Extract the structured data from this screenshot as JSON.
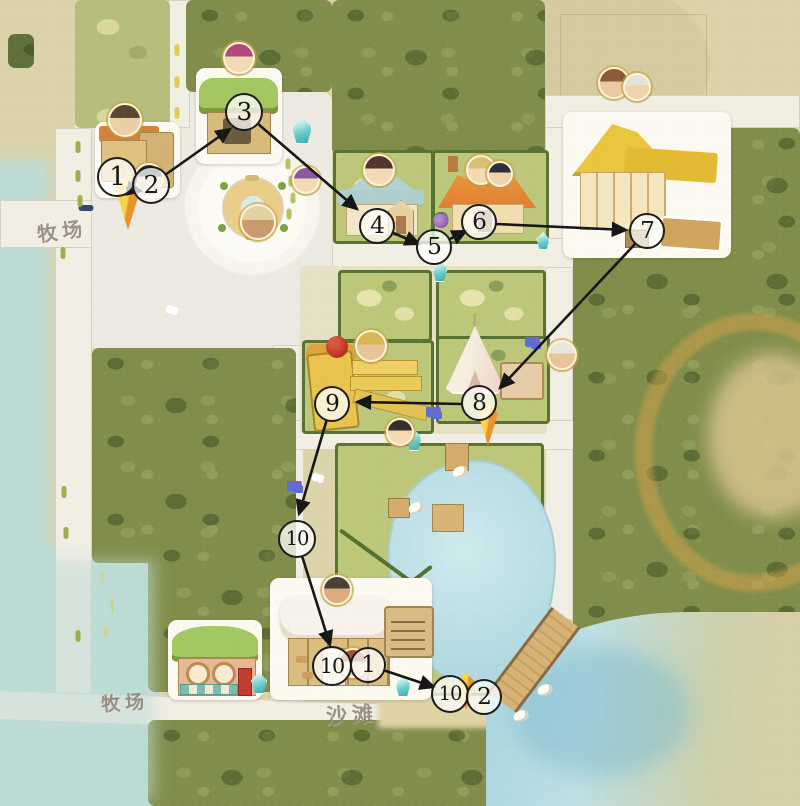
{
  "labels": [
    {
      "id": "ranch-west",
      "text": "牧场",
      "x": 62,
      "y": 230,
      "size": 20,
      "rot": -8
    },
    {
      "id": "ranch-south",
      "text": "牧场",
      "x": 125,
      "y": 702,
      "size": 19,
      "rot": -4
    },
    {
      "id": "beach",
      "text": "沙滩",
      "x": 352,
      "y": 714,
      "size": 21,
      "rot": -4
    }
  ],
  "waypoints": [
    {
      "id": "1",
      "label": "1",
      "x": 117,
      "y": 177,
      "r": 18
    },
    {
      "id": "2",
      "label": "2",
      "x": 151,
      "y": 185,
      "r": 17
    },
    {
      "id": "3",
      "label": "3",
      "x": 244,
      "y": 112,
      "r": 17
    },
    {
      "id": "4",
      "label": "4",
      "x": 377,
      "y": 226,
      "r": 16
    },
    {
      "id": "5",
      "label": "5",
      "x": 434,
      "y": 247,
      "r": 16
    },
    {
      "id": "6",
      "label": "6",
      "x": 479,
      "y": 222,
      "r": 16
    },
    {
      "id": "7",
      "label": "7",
      "x": 647,
      "y": 231,
      "r": 16
    },
    {
      "id": "8",
      "label": "8",
      "x": 479,
      "y": 403,
      "r": 16
    },
    {
      "id": "9",
      "label": "9",
      "x": 332,
      "y": 404,
      "r": 16
    },
    {
      "id": "10",
      "label": "10",
      "x": 297,
      "y": 539,
      "r": 17
    },
    {
      "id": "10-restaurant",
      "label": "10",
      "x": 332,
      "y": 666,
      "r": 18
    },
    {
      "id": "1-restaurant",
      "label": "1",
      "x": 368,
      "y": 665,
      "r": 16
    },
    {
      "id": "10-beach",
      "label": "10",
      "x": 450,
      "y": 694,
      "r": 17
    },
    {
      "id": "2-beach",
      "label": "2",
      "x": 484,
      "y": 697,
      "r": 16
    }
  ],
  "route_arrows": [
    {
      "x1": 126,
      "y1": 188,
      "x2": 141,
      "y2": 191
    },
    {
      "x1": 165,
      "y1": 175,
      "x2": 230,
      "y2": 129
    },
    {
      "x1": 257,
      "y1": 123,
      "x2": 357,
      "y2": 209
    },
    {
      "x1": 391,
      "y1": 232,
      "x2": 419,
      "y2": 244
    },
    {
      "x1": 448,
      "y1": 240,
      "x2": 466,
      "y2": 231
    },
    {
      "x1": 496,
      "y1": 224,
      "x2": 626,
      "y2": 230
    },
    {
      "x1": 636,
      "y1": 243,
      "x2": 500,
      "y2": 388
    },
    {
      "x1": 462,
      "y1": 404,
      "x2": 357,
      "y2": 402
    },
    {
      "x1": 327,
      "y1": 419,
      "x2": 299,
      "y2": 514
    },
    {
      "x1": 302,
      "y1": 556,
      "x2": 330,
      "y2": 645
    },
    {
      "x1": 383,
      "y1": 670,
      "x2": 434,
      "y2": 687
    }
  ],
  "avatars": [
    {
      "name": "ranch-keeper",
      "x": 125,
      "y": 120,
      "r": 15,
      "hair": "#5a4632",
      "skin": "#eccfa6"
    },
    {
      "name": "hooded-villager",
      "x": 149,
      "y": 178,
      "r": 13,
      "hair": "#343a52",
      "skin": "#e8c9a0"
    },
    {
      "name": "pavilion-girl",
      "x": 239,
      "y": 58,
      "r": 14,
      "hair": "#b0487e",
      "skin": "#f3d9b4"
    },
    {
      "name": "plaza-purple-hair-girl",
      "x": 306,
      "y": 180,
      "r": 12,
      "hair": "#8a5a9e",
      "skin": "#f3d9b4"
    },
    {
      "name": "fountain-hat-man",
      "x": 258,
      "y": 222,
      "r": 16,
      "hair": "#e0d2a2",
      "skin": "#c99b6e"
    },
    {
      "name": "bluehouse-girl",
      "x": 379,
      "y": 170,
      "r": 14,
      "hair": "#53342e",
      "skin": "#f3d9b4"
    },
    {
      "name": "orangehouse-blonde",
      "x": 481,
      "y": 170,
      "r": 13,
      "hair": "#d8c074",
      "skin": "#f3d9b4"
    },
    {
      "name": "orangehouse-darkhair",
      "x": 500,
      "y": 174,
      "r": 11,
      "hair": "#2e2e38",
      "skin": "#f0d3ac"
    },
    {
      "name": "yellowhouse-man",
      "x": 614,
      "y": 83,
      "r": 14,
      "hair": "#8a5a3a",
      "skin": "#ecc9a0"
    },
    {
      "name": "yellowhouse-granny",
      "x": 637,
      "y": 87,
      "r": 12,
      "hair": "#e4e2dc",
      "skin": "#f0d3ac"
    },
    {
      "name": "mill-blacksmith",
      "x": 371,
      "y": 346,
      "r": 14,
      "hair": "#d8b856",
      "skin": "#e8c498"
    },
    {
      "name": "tent-elder",
      "x": 562,
      "y": 355,
      "r": 13,
      "hair": "#e8e6e0",
      "skin": "#e8c498"
    },
    {
      "name": "lakeside-woman",
      "x": 400,
      "y": 432,
      "r": 12,
      "hair": "#3a3028",
      "skin": "#f3d9b4"
    },
    {
      "name": "restaurant-chef",
      "x": 337,
      "y": 590,
      "r": 13,
      "hair": "#4a4038",
      "skin": "#dcab7e"
    },
    {
      "name": "restaurant-waitress",
      "x": 353,
      "y": 663,
      "r": 13,
      "hair": "#a8502c",
      "skin": "#f3d9b4"
    }
  ],
  "markers": [
    {
      "name": "player-pin-ranch",
      "x": 128,
      "top": 172,
      "w": 34,
      "h": 58
    },
    {
      "name": "pin-tent",
      "x": 488,
      "top": 402,
      "w": 26,
      "h": 44
    },
    {
      "name": "pin-beach",
      "x": 466,
      "top": 672,
      "w": 24,
      "h": 38
    }
  ],
  "items": {
    "crystals": [
      {
        "x": 302,
        "y": 144,
        "w": 20,
        "h": 27
      },
      {
        "x": 440,
        "y": 282,
        "w": 15,
        "h": 21
      },
      {
        "x": 543,
        "y": 250,
        "w": 13,
        "h": 18
      },
      {
        "x": 414,
        "y": 451,
        "w": 15,
        "h": 22
      },
      {
        "x": 403,
        "y": 697,
        "w": 15,
        "h": 21
      },
      {
        "x": 259,
        "y": 694,
        "w": 16,
        "h": 22
      }
    ],
    "grapes": [
      {
        "x": 441,
        "y": 221
      }
    ],
    "flowers": [
      {
        "x": 533,
        "y": 343
      },
      {
        "x": 434,
        "y": 413
      },
      {
        "x": 295,
        "y": 487
      }
    ],
    "butterflies": [
      {
        "x": 172,
        "y": 310
      },
      {
        "x": 318,
        "y": 478
      }
    ],
    "birds": [
      {
        "x": 460,
        "y": 472
      },
      {
        "x": 416,
        "y": 508
      },
      {
        "x": 545,
        "y": 690
      },
      {
        "x": 521,
        "y": 716
      }
    ],
    "benches": [
      {
        "x": 86,
        "y": 208,
        "w": 15,
        "h": 6,
        "c": "#3a4668"
      }
    ],
    "road_dashes": [
      {
        "x": 78,
        "y": 147,
        "w": 5,
        "h": 12,
        "c": "#9fae4e"
      },
      {
        "x": 78,
        "y": 176,
        "w": 5,
        "h": 12,
        "c": "#9fae4e"
      },
      {
        "x": 80,
        "y": 201,
        "w": 5,
        "h": 12,
        "c": "#9fae4e"
      },
      {
        "x": 63,
        "y": 253,
        "w": 5,
        "h": 12,
        "c": "#9fae4e"
      },
      {
        "x": 64,
        "y": 492,
        "w": 5,
        "h": 12,
        "c": "#9fae4e"
      },
      {
        "x": 66,
        "y": 533,
        "w": 5,
        "h": 12,
        "c": "#9fae4e"
      },
      {
        "x": 78,
        "y": 636,
        "w": 5,
        "h": 12,
        "c": "#9fae4e"
      },
      {
        "x": 177,
        "y": 50,
        "w": 5,
        "h": 12,
        "c": "#e0cc52"
      },
      {
        "x": 177,
        "y": 82,
        "w": 5,
        "h": 12,
        "c": "#e0cc52"
      },
      {
        "x": 177,
        "y": 113,
        "w": 5,
        "h": 12,
        "c": "#e0cc52"
      },
      {
        "x": 288,
        "y": 164,
        "w": 5,
        "h": 11,
        "c": "#b8c35f"
      },
      {
        "x": 291,
        "y": 181,
        "w": 5,
        "h": 11,
        "c": "#b8c35f"
      },
      {
        "x": 293,
        "y": 198,
        "w": 5,
        "h": 11,
        "c": "#b8c35f"
      },
      {
        "x": 289,
        "y": 214,
        "w": 5,
        "h": 11,
        "c": "#b8c35f"
      }
    ]
  },
  "colors": {
    "parchment": "#dcd3ab",
    "forest": "#818d4b",
    "farm_green": "#bdc77a",
    "hedge": "#587231",
    "road": "#f1eee4",
    "pond": "#b9dde4",
    "sea": "#abd6e0",
    "bridge": "#d6b277",
    "pin_yellow": "#f9d44a",
    "pin_orange": "#e8932c",
    "crystal_teal": "#62cac8",
    "arrow": "#161616",
    "waypoint_border": "#1b1b1b",
    "ochre_ring": "#d5a44a",
    "roof_orange": "#e58a3c",
    "roof_blue": "#b4d2d2",
    "roof_yellow": "#eac63e",
    "roof_green": "#a3c861",
    "mill_yellow": "#e8c44f",
    "red_ball": "#b23322"
  }
}
